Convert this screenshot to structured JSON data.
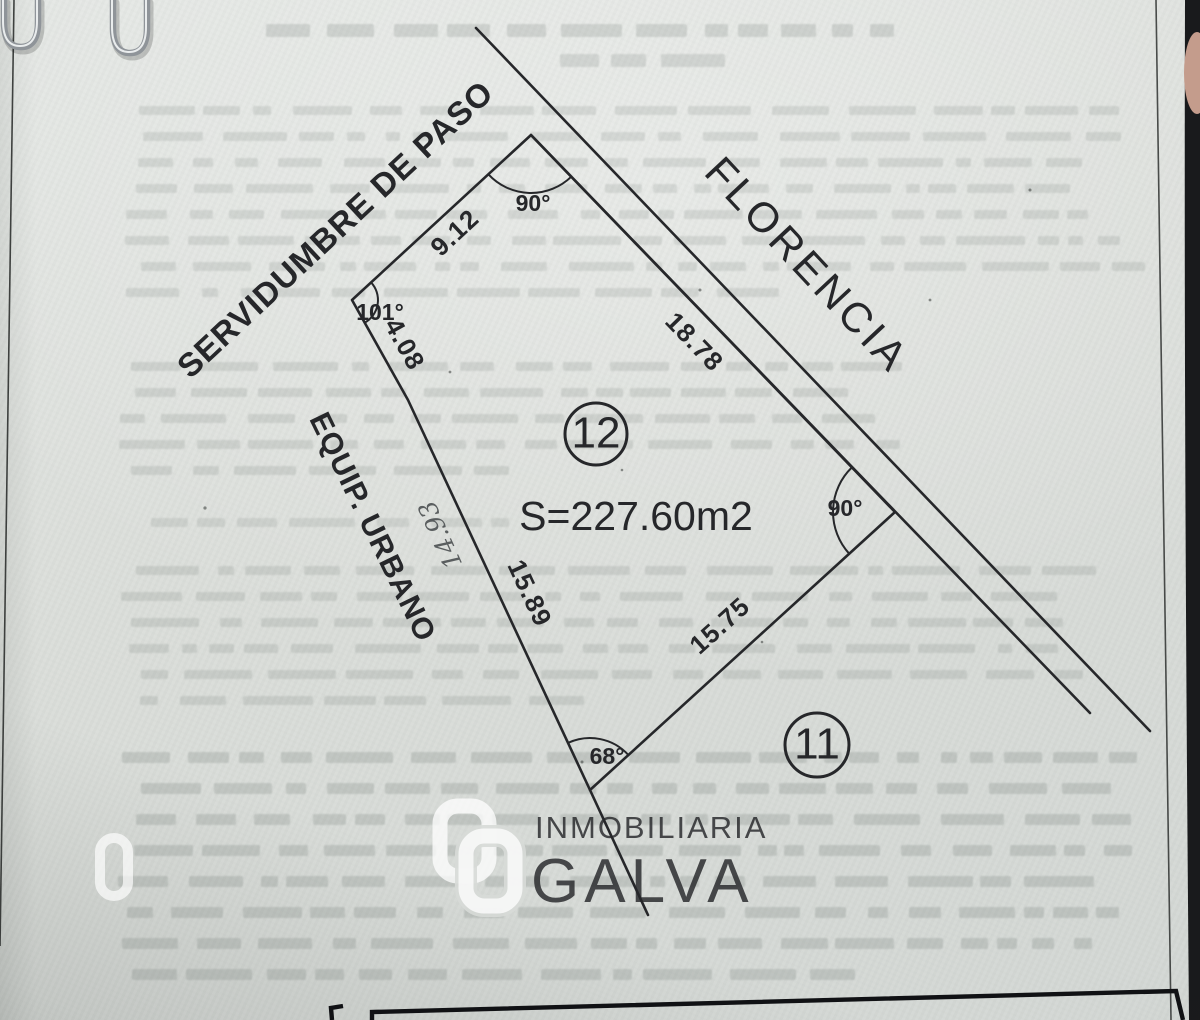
{
  "page": {
    "kind": "scanned land-survey delivery document",
    "paper_color": "#dbdeda",
    "ink_color": "#26272a",
    "table_line_color": "#101114",
    "background_edge_color": "#191a1c",
    "paperclip_color": "#9aa0a5",
    "finger_color": "#c49c8c"
  },
  "diagram": {
    "easement_label": "SERVIDUMBRE DE PASO",
    "street_name": "FLORENCIA",
    "adjacent_facility_label": "EQUIP. URBANO",
    "lot_number": "12",
    "neighbor_lot_number": "11",
    "area": "S=227.60m2",
    "dimensions": {
      "northwest": "9.12",
      "west_upper": "4.08",
      "west_lower": "15.89",
      "south": "15.75",
      "front": "18.78",
      "handwritten": "14.93"
    },
    "angles": {
      "top": "90°",
      "left": "101°",
      "right": "90°",
      "bottom": "68°"
    }
  },
  "watermark": {
    "brand_top": "INMOBILIARIA",
    "brand_bottom": "GALVA",
    "logo": "galva-interlocked-links-logo",
    "color": "#ffffff"
  },
  "illegible_bands": [
    {
      "name": "document-title-line-1",
      "x": 250,
      "y": 24,
      "width": 660,
      "lines": 1,
      "line_gap": 26,
      "word_h": 13,
      "opacity": 0.2,
      "seed": 11,
      "center": true
    },
    {
      "name": "document-title-line-2",
      "x": 555,
      "y": 54,
      "width": 190,
      "lines": 1,
      "line_gap": 26,
      "word_h": 13,
      "opacity": 0.18,
      "seed": 21,
      "center": true
    },
    {
      "name": "paragraph-band-1",
      "x": 118,
      "y": 106,
      "width": 1030,
      "lines": 8,
      "line_gap": 26,
      "word_h": 9,
      "opacity": 0.16,
      "seed": 31
    },
    {
      "name": "paragraph-band-2",
      "x": 118,
      "y": 362,
      "width": 790,
      "lines": 5,
      "line_gap": 26,
      "word_h": 9,
      "opacity": 0.17,
      "seed": 41
    },
    {
      "name": "paragraph-line-3",
      "x": 150,
      "y": 518,
      "width": 420,
      "lines": 1,
      "line_gap": 26,
      "word_h": 9,
      "opacity": 0.15,
      "seed": 51
    },
    {
      "name": "paragraph-band-4",
      "x": 118,
      "y": 566,
      "width": 1035,
      "lines": 6,
      "line_gap": 26,
      "word_h": 9,
      "opacity": 0.17,
      "seed": 61
    },
    {
      "name": "paragraph-band-5",
      "x": 118,
      "y": 752,
      "width": 1040,
      "lines": 8,
      "line_gap": 31,
      "word_h": 11,
      "opacity": 0.22,
      "seed": 71
    }
  ]
}
